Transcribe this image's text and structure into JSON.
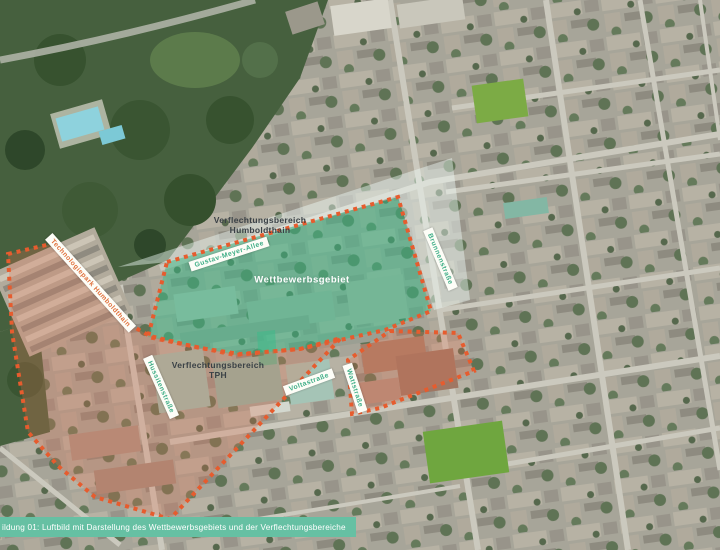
{
  "figure": {
    "type": "aerial-photo-map",
    "caption": "ildung 01: Luftbild mit Darstellung des Wettbewerbsgebiets und der Verflechtungsbereiche"
  },
  "areas": {
    "competition": {
      "label": "Wettbewerbsgebiet",
      "fill": "#3cbc8a"
    },
    "humboldthain": {
      "label_line1": "Verflechtungsbereich",
      "label_line2": "Humboldthain",
      "fill": "#eef7f2"
    },
    "tph": {
      "label_line1": "Verflechtungsbereich",
      "label_line2": "TPH",
      "fill": "#e06e50"
    }
  },
  "street_banners": [
    {
      "name": "Gustav-Meyer-Allee"
    },
    {
      "name": "Brunnenstraße"
    },
    {
      "name": "Hussitenstraße"
    },
    {
      "name": "Voltastraße"
    },
    {
      "name": "Wattstraße"
    }
  ],
  "park_banner": {
    "name": "Technologiepark Humboldthain"
  },
  "colors": {
    "boundary_dash": "#e65c2e",
    "competition_green": "#3cbc8a",
    "tph_red": "#e06e50",
    "caption_bar": "#66c0a3",
    "street_label_green": "#3fae87",
    "park_banner_orange": "#e0703c",
    "park_forest": "#46603e",
    "pool_blue": "#8ed2dd"
  }
}
